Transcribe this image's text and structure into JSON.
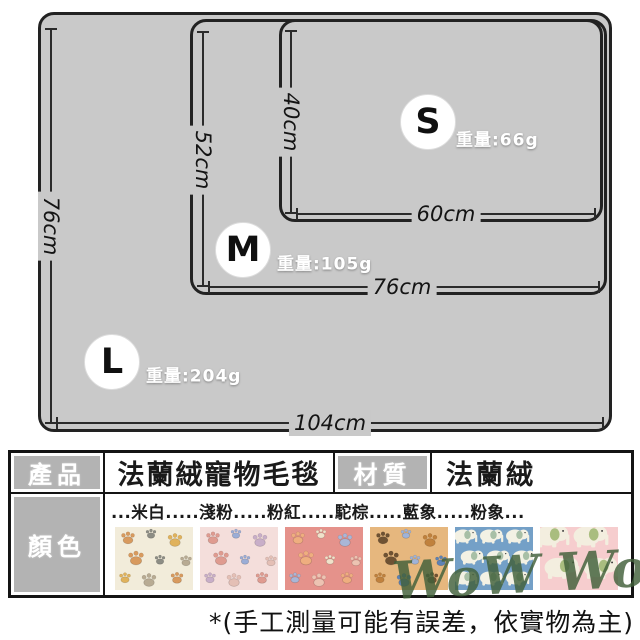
{
  "diagram": {
    "sizes": [
      {
        "letter": "L",
        "weight": "重量:204g",
        "height": "76cm",
        "width": "104cm"
      },
      {
        "letter": "M",
        "weight": "重量:105g",
        "height": "52cm",
        "width": "76cm"
      },
      {
        "letter": "S",
        "weight": "重量:66g",
        "height": "40cm",
        "width": "60cm"
      }
    ],
    "blanket_fill": "#c9c9c9",
    "blanket_border": "#222222"
  },
  "table": {
    "product_label": "產品",
    "product_value": "法蘭絨寵物毛毯",
    "material_label": "材質",
    "material_value": "法蘭絨",
    "color_label": "顏色",
    "color_names_line": "...米白.....淺粉.....粉紅.....駝棕.....藍象.....粉象...",
    "header_gray": "#b3b3b3",
    "swatches": [
      {
        "name": "米白",
        "pattern": "paw",
        "base": "#f2ecda",
        "accents": [
          "#d89a5e",
          "#8d8d85",
          "#e0b25c",
          "#b8ab93"
        ]
      },
      {
        "name": "淺粉",
        "pattern": "paw",
        "base": "#f4dedb",
        "accents": [
          "#df9b90",
          "#9badd6",
          "#c8aec8",
          "#e4bfb5"
        ]
      },
      {
        "name": "粉紅",
        "pattern": "paw",
        "base": "#e5928b",
        "accents": [
          "#efae7f",
          "#f0e2ca",
          "#a9b6d6",
          "#edc3b2"
        ]
      },
      {
        "name": "駝棕",
        "pattern": "paw",
        "base": "#e6b77e",
        "accents": [
          "#6f5233",
          "#9fb3d9",
          "#c0813d",
          "#5d82b5"
        ]
      },
      {
        "name": "藍象",
        "pattern": "elephant",
        "cols": 3,
        "rows": 3,
        "base": "#74a0c7",
        "accents": [
          "#f3f1e4",
          "#a8bfa6"
        ]
      },
      {
        "name": "粉象",
        "pattern": "elephant",
        "cols": 2,
        "rows": 2,
        "base": "#f6cdce",
        "accents": [
          "#f3eedf",
          "#a9bd7f"
        ]
      }
    ]
  },
  "watermark": "WoW WoW",
  "footnote": "*(手工測量可能有誤差，依實物為主)"
}
